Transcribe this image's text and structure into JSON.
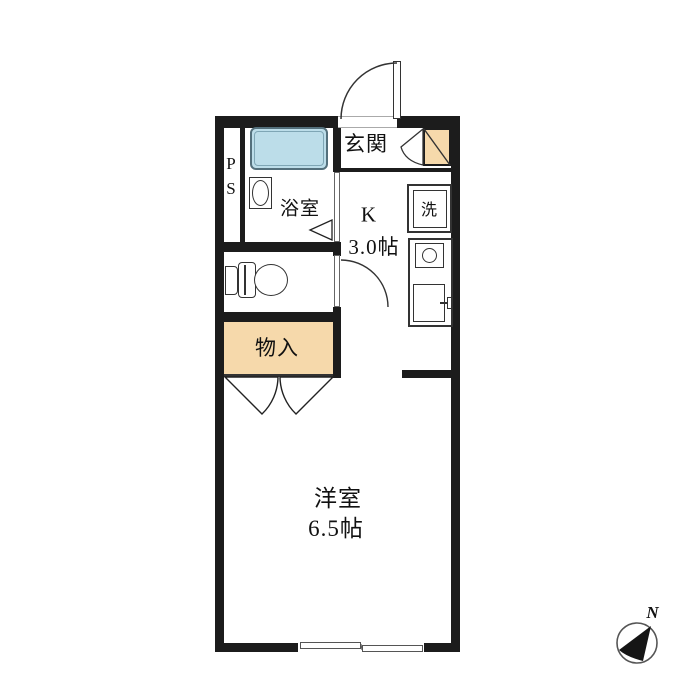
{
  "floorplan": {
    "rooms": {
      "entrance": {
        "label": "玄関"
      },
      "bathroom": {
        "label": "浴室"
      },
      "pipe_space": {
        "line1": "P",
        "line2": "S"
      },
      "kitchen": {
        "label": "K",
        "size": "3.0帖"
      },
      "washer": {
        "label": "洗"
      },
      "storage": {
        "label": "物入"
      },
      "western_room": {
        "label": "洋室",
        "size": "6.5帖"
      }
    },
    "compass": {
      "north": "N"
    },
    "colors": {
      "wall": "#1c1c1c",
      "accent_tan": "#f6d9ab",
      "bathtub_blue": "#bcdde9",
      "fixture_line": "#333333"
    }
  }
}
